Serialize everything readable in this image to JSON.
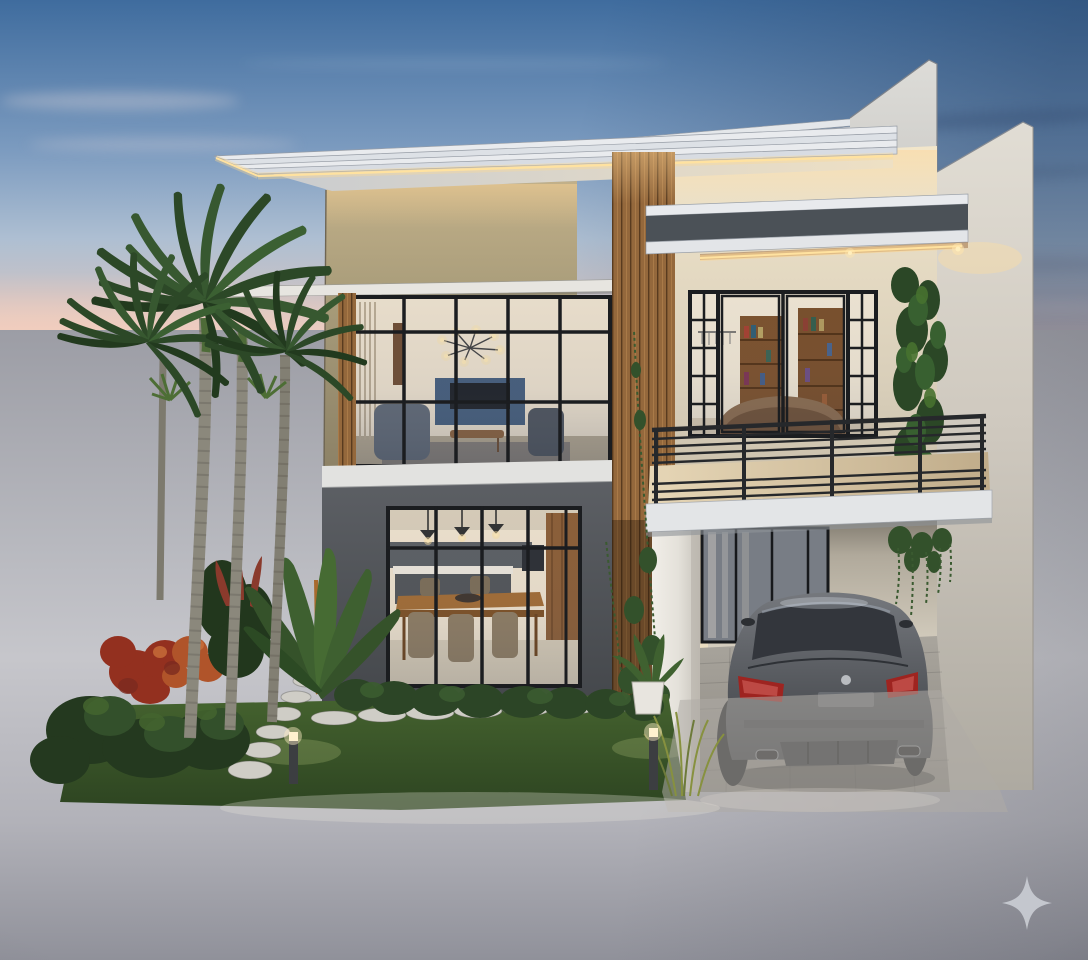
{
  "scene": {
    "type": "3d-architectural-render",
    "description": "Modern two-storey tropical house at dusk with flat LED-lit roofs, wood slat accents, glass walls showing lit interiors, balcony, carport with parked sedan, palm trees and landscaped front garden",
    "time_of_day": "dusk"
  },
  "watermark": {
    "icon": "sparkle-icon",
    "color": "#c9ccd3"
  },
  "palette": {
    "sky-top": "#3f6c9e",
    "sky-mid": "#7d9cc0",
    "sky-light": "#aebfd2",
    "sky-horizon": "#e9cdc3",
    "wall-gray": "#9c9da5",
    "street-gray": "#c6c6cb",
    "roof-white": "#e9ebee",
    "led-warm": "#ffdf9e",
    "stucco-beige": "#a89c7a",
    "wood-slat": "#94683c",
    "wall-white-lit": "#efe3cd",
    "canopy-band-gray": "#4b5157",
    "ground-floor-gray": "#54575c",
    "window-frame-black": "#1b1d20",
    "interior-warm": "#f0e3cd",
    "interior-navy": "#3e5877",
    "railing-dark": "#26282b",
    "balcony-floor": "#d7c5a2",
    "car-gray": "#5b5e63",
    "taillight-red": "#9e2420",
    "lawn-green": "#3d5a2c",
    "foliage-green": "#33502b",
    "foliage-dark": "#24391f",
    "shrub-red": "#93301f",
    "shrub-orange": "#b0542a",
    "palm-green": "#2c4827",
    "trunk-gray": "#8b887c",
    "stone-light": "#cfcdc6",
    "pot-white": "#e8e5df",
    "watermark-gray": "#c9ccd3"
  },
  "elements": {
    "background": [
      "dusk sky",
      "streaky clouds",
      "pink horizon band",
      "perimeter wall",
      "street"
    ],
    "house": [
      "main flat roof with LED strip",
      "rear roof fascia",
      "stepped parapet fins",
      "beige stucco upper wall",
      "wood slat column",
      "living room window wall",
      "sunshade ledge",
      "floor slab band",
      "dark ground-floor wall",
      "kitchen window wall",
      "entrance canopy with LED",
      "balcony with metal railing",
      "balcony french doors",
      "green vine wall",
      "carport",
      "white column"
    ],
    "interiors": [
      "sputnik chandelier",
      "navy media wall",
      "armchairs",
      "coffee table",
      "dining table and chairs",
      "kitchen island",
      "pendant lights",
      "bookshelves",
      "bed"
    ],
    "landscape": [
      "royal palm trees",
      "red and green shrubs",
      "banana plant",
      "hedge",
      "lawn",
      "stepping stones",
      "bollard lights",
      "potted plant",
      "hanging vines"
    ],
    "vehicle": [
      "gray sedan parked in carport"
    ]
  }
}
